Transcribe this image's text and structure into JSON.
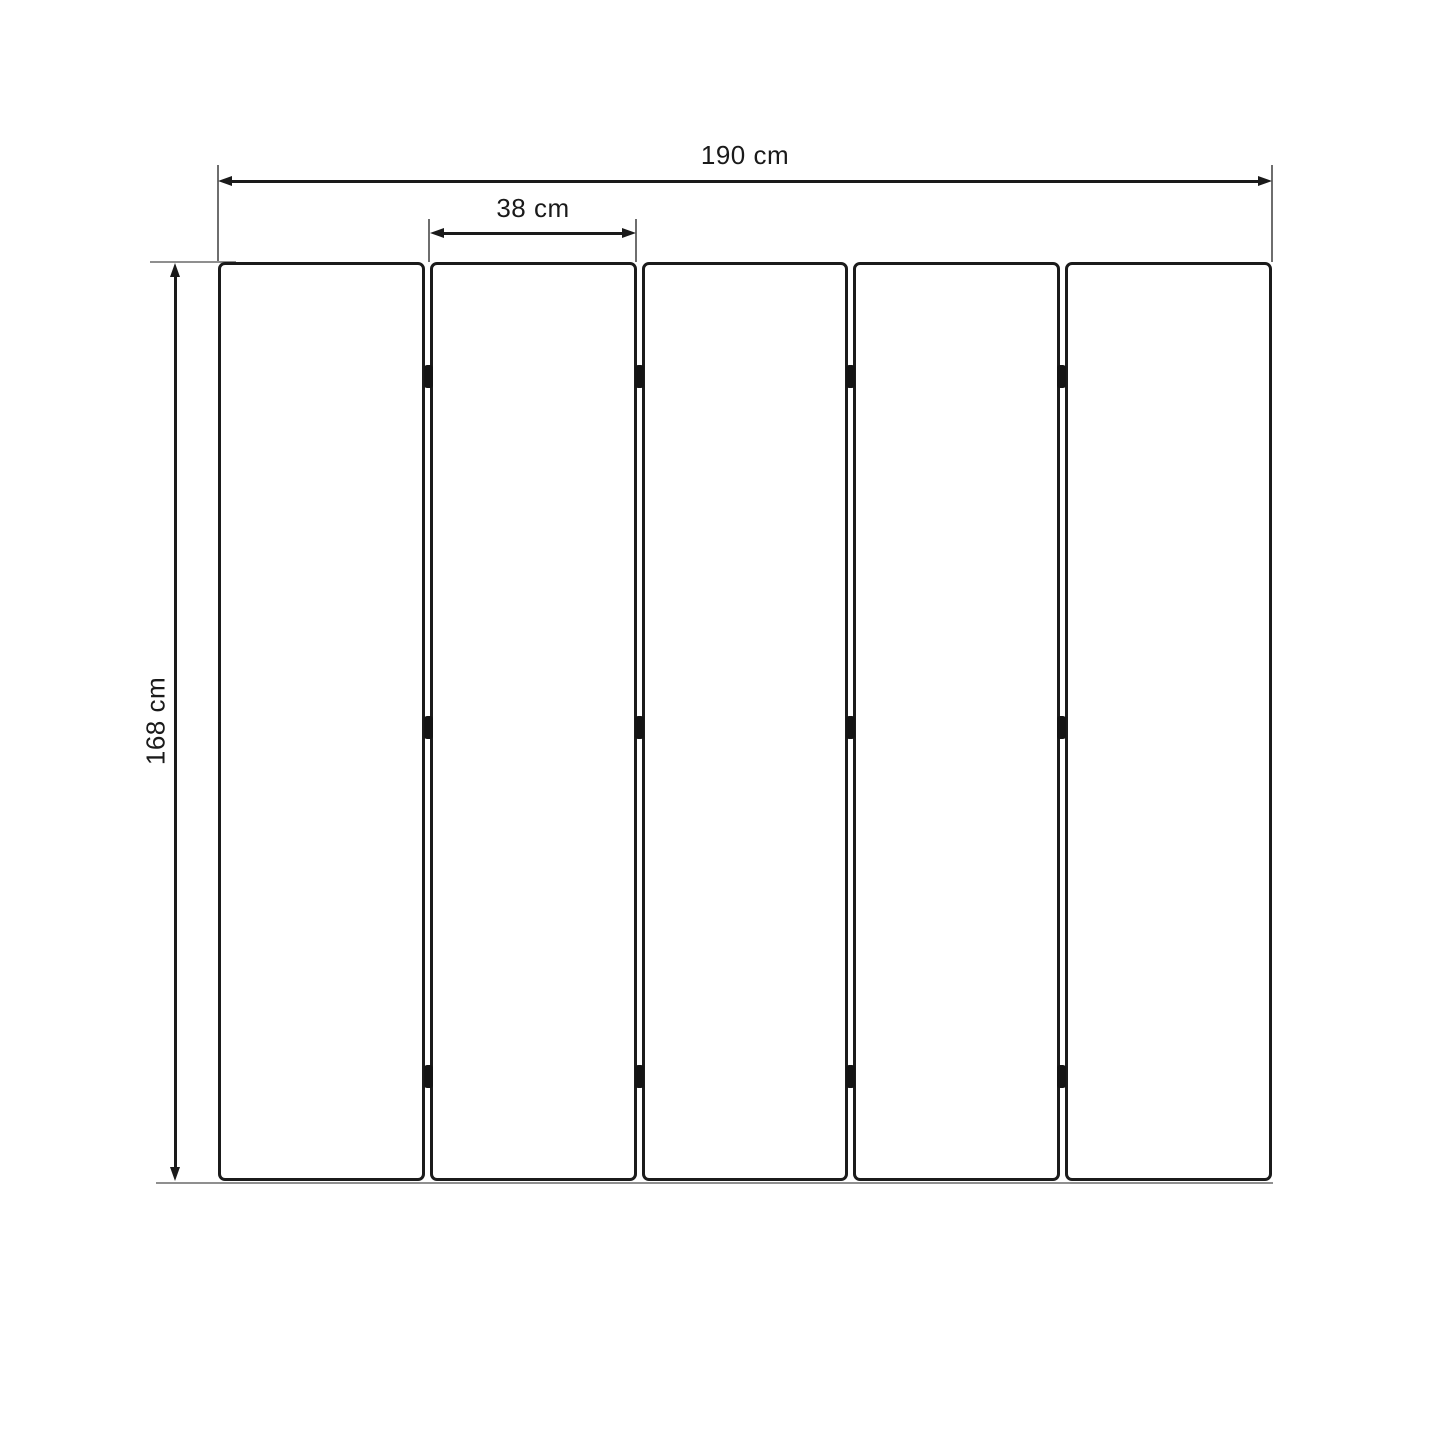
{
  "diagram": {
    "type": "dimension-drawing",
    "subject": "five-panel folding screen front view"
  },
  "dimensions": {
    "total_width_label": "190 cm",
    "panel_width_label": "38 cm",
    "height_label": "168 cm"
  },
  "panels": {
    "count": 5,
    "hinge_joints": 4,
    "hinges_per_joint": 3,
    "hinge_positions_pct": [
      12.5,
      50.6,
      88.6
    ]
  },
  "colors": {
    "background": "#ffffff",
    "panel_border": "#1b1b1b",
    "dimension_line": "#1a1a1a",
    "extension_line": "#6e6e6e",
    "ground_line": "#8f8f8f",
    "hinge": "#141414"
  }
}
